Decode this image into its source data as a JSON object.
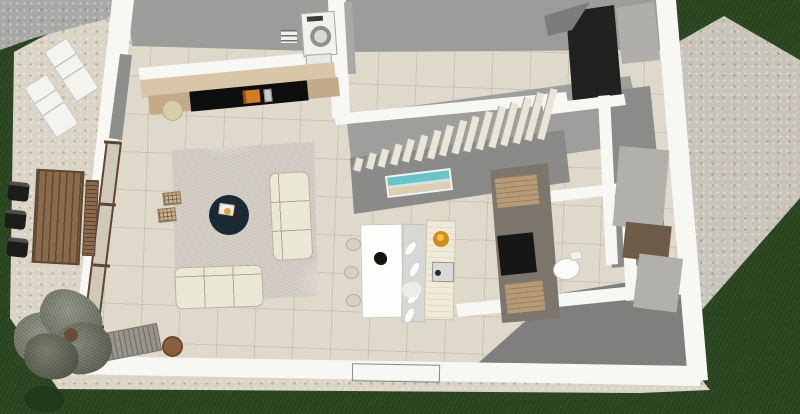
{
  "scene": {
    "name": "house-ground-floor-3d-plan",
    "view": "top-down perspective architectural render",
    "rooms": [
      "living room",
      "dining area",
      "kitchen",
      "hallway",
      "staircase",
      "laundry",
      "wc",
      "terrace",
      "driveway",
      "garden"
    ],
    "stairs": {
      "step_count": 16
    },
    "counts": {
      "lounge_chairs": 2,
      "terrace_dining_chairs": 3,
      "terrace_bench": 1,
      "dining_chairs": 3,
      "pendant_lamps": 4,
      "sofas": 2,
      "ottomans": 2,
      "trees": 1
    }
  },
  "palette": {
    "grass": "#2b4720",
    "grass_shrub": "#23391b",
    "patio": "#dad4c6",
    "driveway": "#a8a8a6",
    "gravel": "#c9c4b9",
    "wall_white": "#f7f7f4",
    "wall_gray": "#9c9c9a",
    "wall_dark": "#212120",
    "floor_tile": "#ded9cb",
    "floor_gray": "#8b8b89",
    "floor_gray_dark": "#7f7f7d",
    "stairs_bg": "#9e9e9c",
    "stairs_wall": "#8a8a88",
    "stairs_step": "#e9e5d8",
    "rug": "#d4cfc6",
    "sofa": "#ebe7d7",
    "coffee_table": "#1b2934",
    "console_wood": "#c3ab8a",
    "shelf_wood": "#d9c6a8",
    "tv": "#0e0e0e",
    "accent_orange": "#cf7e26",
    "pouf_basket": "#d9cda9",
    "pouf_leather": "#8a5f3d",
    "ottoman": "#c9b18f",
    "appliance_white": "#f1f1ee",
    "table_white": "#fdfdfb",
    "island_gray": "#d7d7d5",
    "island_cream": "#f0ead9",
    "fruit_bowl": "#d28b1f",
    "counter_wood": "#b79b79",
    "cooktop": "#161616",
    "outdoor_wood": "#8a6a4c",
    "outdoor_chair": "#1c1c1b",
    "art_sky": "#6ac3c9",
    "art_sand": "#ddd0b2",
    "tree_foliage": "#7e8370",
    "tree_trunk": "#6b4e36"
  }
}
